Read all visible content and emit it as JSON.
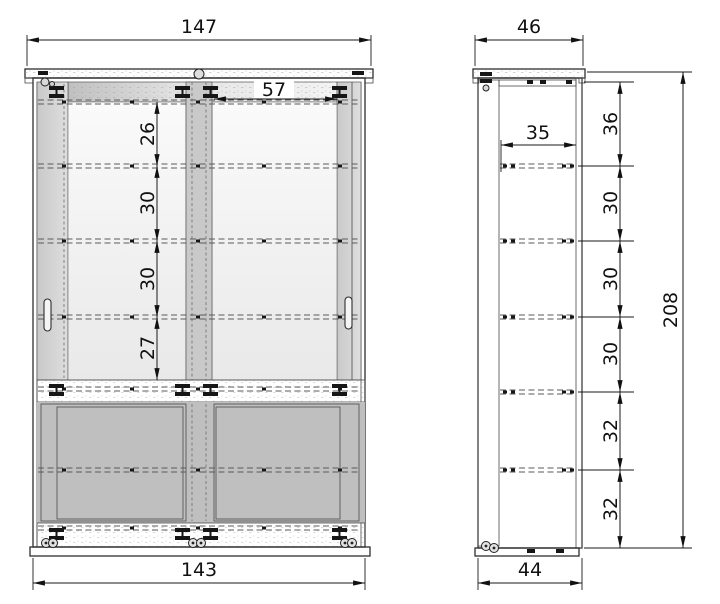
{
  "page": {
    "background": "#ffffff"
  },
  "drawing": {
    "title": "cabinet-dimension-drawing",
    "line_color": "#2e2e2e",
    "front_view": {
      "width_top": "147",
      "width_bottom": "143",
      "door_glass_width": "57",
      "section_heights": [
        "26",
        "30",
        "30",
        "27"
      ]
    },
    "side_view": {
      "depth_top": "46",
      "depth_bottom": "44",
      "interior_depth": "35",
      "total_height": "208",
      "section_heights": [
        "36",
        "30",
        "30",
        "30",
        "32",
        "32"
      ]
    }
  }
}
